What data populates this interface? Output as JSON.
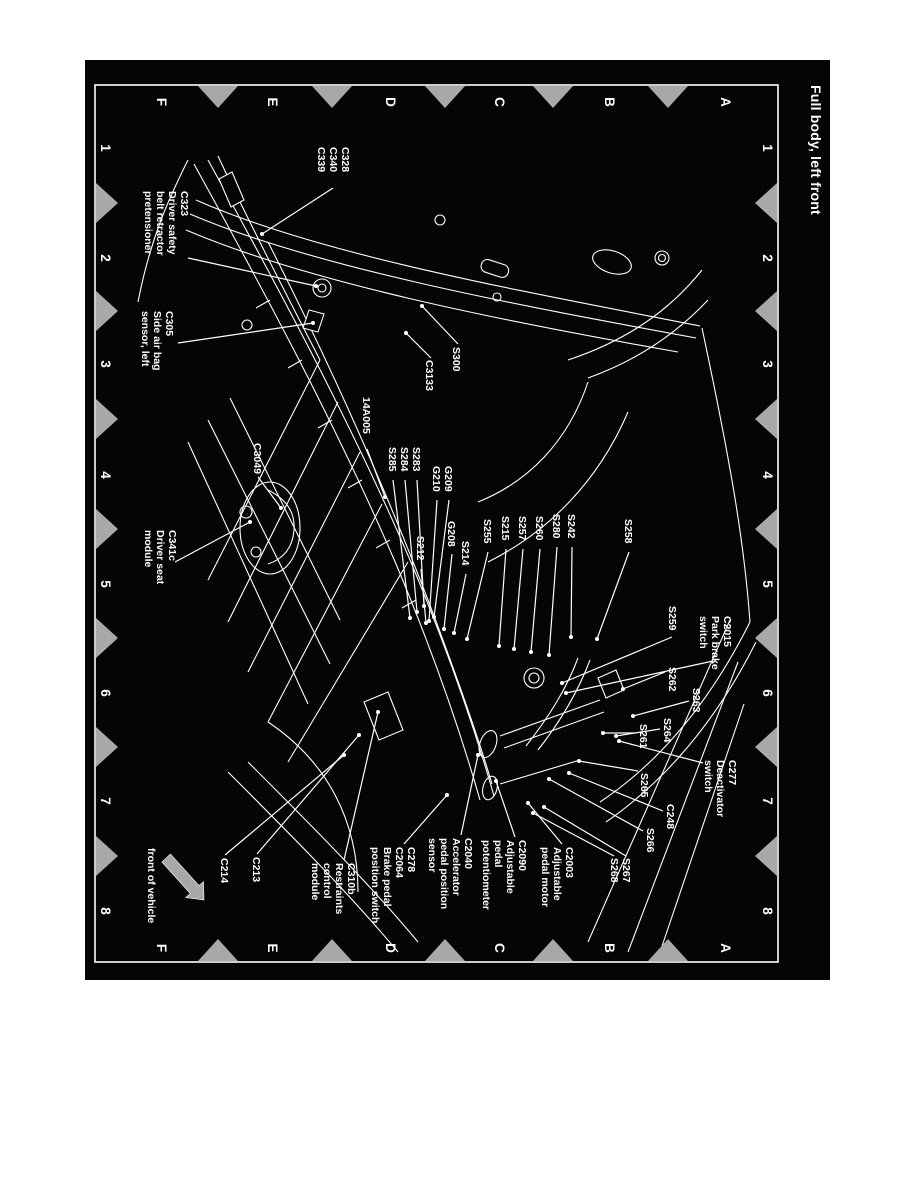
{
  "title": "Full body, left front",
  "front": {
    "label": "front of vehicle"
  },
  "grid": {
    "column_labels": [
      "1",
      "2",
      "3",
      "4",
      "5",
      "6",
      "7",
      "8"
    ],
    "row_labels": [
      "A",
      "B",
      "C",
      "D",
      "E",
      "F"
    ]
  },
  "colors": {
    "paper": "#ffffff",
    "sheet_background": "#050505",
    "ink": "#ffffff",
    "registration_mark": "#a8a8a8"
  },
  "labels": [
    {
      "id": "C328-group",
      "lines": [
        "C328",
        "C340",
        "C339"
      ],
      "x": 87,
      "y": 488,
      "leaders": [
        [
          128,
          497,
          174,
          568
        ]
      ]
    },
    {
      "id": "C323",
      "lines": [
        "C323",
        "Driver safety",
        "belt retractor",
        "pretensioner"
      ],
      "x": 131,
      "y": 649,
      "leaders": [
        [
          198,
          642,
          226,
          514
        ]
      ]
    },
    {
      "id": "C305",
      "lines": [
        "C305",
        "Side air bag",
        "sensor, left"
      ],
      "x": 251,
      "y": 664,
      "leaders": [
        [
          283,
          652,
          263,
          517
        ]
      ]
    },
    {
      "id": "S300",
      "lines": [
        "S300"
      ],
      "x": 287,
      "y": 377,
      "leaders": [
        [
          284,
          372,
          246,
          408
        ]
      ]
    },
    {
      "id": "C3133",
      "lines": [
        "C3133"
      ],
      "x": 300,
      "y": 404,
      "leaders": [
        [
          298,
          399,
          273,
          424
        ]
      ]
    },
    {
      "id": "14A005",
      "lines": [
        "14A005"
      ],
      "x": 337,
      "y": 467,
      "leaders": [
        [
          389,
          463,
          437,
          445
        ]
      ]
    },
    {
      "id": "S283-group",
      "lines": [
        "S283",
        "S284",
        "S285"
      ],
      "x": 387,
      "y": 417,
      "leaders": [
        [
          420,
          413,
          546,
          406
        ],
        [
          420,
          425,
          552,
          413
        ],
        [
          420,
          437,
          558,
          420
        ]
      ]
    },
    {
      "id": "G209-group",
      "lines": [
        "G209",
        "G210"
      ],
      "x": 406,
      "y": 385,
      "leaders": [
        [
          440,
          381,
          557,
          396
        ],
        [
          440,
          393,
          561,
          401
        ]
      ]
    },
    {
      "id": "S212",
      "lines": [
        "S212"
      ],
      "x": 476,
      "y": 413,
      "leaders": [
        [
          509,
          409,
          563,
          404
        ]
      ]
    },
    {
      "id": "G208",
      "lines": [
        "G208"
      ],
      "x": 461,
      "y": 382,
      "leaders": [
        [
          494,
          378,
          569,
          386
        ]
      ]
    },
    {
      "id": "S214",
      "lines": [
        "S214"
      ],
      "x": 481,
      "y": 368,
      "leaders": [
        [
          514,
          364,
          573,
          376
        ]
      ]
    },
    {
      "id": "S255",
      "lines": [
        "S255"
      ],
      "x": 459,
      "y": 346,
      "leaders": [
        [
          492,
          342,
          579,
          363
        ]
      ]
    },
    {
      "id": "S215",
      "lines": [
        "S215"
      ],
      "x": 456,
      "y": 328,
      "leaders": [
        [
          489,
          324,
          586,
          331
        ]
      ]
    },
    {
      "id": "S257",
      "lines": [
        "S257"
      ],
      "x": 456,
      "y": 311,
      "leaders": [
        [
          489,
          307,
          589,
          316
        ]
      ]
    },
    {
      "id": "S260",
      "lines": [
        "S260"
      ],
      "x": 456,
      "y": 294,
      "leaders": [
        [
          489,
          290,
          592,
          299
        ]
      ]
    },
    {
      "id": "S280",
      "lines": [
        "S280"
      ],
      "x": 454,
      "y": 277,
      "leaders": [
        [
          487,
          273,
          595,
          281
        ]
      ]
    },
    {
      "id": "S242",
      "lines": [
        "S242"
      ],
      "x": 454,
      "y": 262,
      "leaders": [
        [
          487,
          258,
          577,
          259
        ]
      ]
    },
    {
      "id": "S258",
      "lines": [
        "S258"
      ],
      "x": 459,
      "y": 205,
      "leaders": [
        [
          492,
          201,
          579,
          233
        ]
      ]
    },
    {
      "id": "S259",
      "lines": [
        "S259"
      ],
      "x": 546,
      "y": 161,
      "leaders": [
        [
          577,
          158,
          623,
          268
        ]
      ]
    },
    {
      "id": "C2015",
      "lines": [
        "C2015",
        "Park brake",
        "switch"
      ],
      "x": 556,
      "y": 106,
      "leaders": [
        [
          601,
          117,
          633,
          264
        ]
      ]
    },
    {
      "id": "S262",
      "lines": [
        "S262"
      ],
      "x": 607,
      "y": 161,
      "leaders": [
        [
          612,
          165,
          629,
          207
        ]
      ]
    },
    {
      "id": "S263",
      "lines": [
        "S263"
      ],
      "x": 628,
      "y": 137,
      "leaders": [
        [
          641,
          141,
          656,
          197
        ]
      ]
    },
    {
      "id": "S264",
      "lines": [
        "S264"
      ],
      "x": 658,
      "y": 166,
      "leaders": [
        [
          669,
          170,
          676,
          214
        ]
      ]
    },
    {
      "id": "S261",
      "lines": [
        "S261"
      ],
      "x": 664,
      "y": 190,
      "leaders": [
        [
          673,
          194,
          673,
          227
        ]
      ]
    },
    {
      "id": "C277",
      "lines": [
        "C277",
        "Deactivator",
        "switch"
      ],
      "x": 700,
      "y": 101,
      "leaders": [
        [
          703,
          127,
          681,
          211
        ]
      ]
    },
    {
      "id": "S265",
      "lines": [
        "S265"
      ],
      "x": 713,
      "y": 189,
      "leaders": [
        [
          711,
          192,
          701,
          251
        ]
      ]
    },
    {
      "id": "C248",
      "lines": [
        "C248"
      ],
      "x": 744,
      "y": 163,
      "leaders": [
        [
          751,
          167,
          713,
          261
        ]
      ]
    },
    {
      "id": "S266",
      "lines": [
        "S266"
      ],
      "x": 768,
      "y": 183,
      "leaders": [
        [
          771,
          187,
          719,
          281
        ]
      ]
    },
    {
      "id": "S267-group",
      "lines": [
        "S267",
        "S268"
      ],
      "x": 798,
      "y": 207,
      "leaders": [
        [
          796,
          204,
          747,
          286
        ],
        [
          796,
          216,
          753,
          297
        ]
      ]
    },
    {
      "id": "C2003",
      "lines": [
        "C2003",
        "Adjustable",
        "pedal motor"
      ],
      "x": 787,
      "y": 264,
      "leaders": [
        [
          784,
          268,
          743,
          302
        ]
      ]
    },
    {
      "id": "C2090",
      "lines": [
        "C2090",
        "Adjustable",
        "pedal",
        "potentiometer"
      ],
      "x": 780,
      "y": 311,
      "leaders": [
        [
          777,
          315,
          721,
          334
        ]
      ]
    },
    {
      "id": "C2040",
      "lines": [
        "C2040",
        "Accelerator",
        "pedal position",
        "sensor"
      ],
      "x": 778,
      "y": 365,
      "leaders": [
        [
          775,
          369,
          695,
          352
        ]
      ]
    },
    {
      "id": "C278",
      "lines": [
        "C278",
        "C2064",
        "Brake pedal",
        "position switch"
      ],
      "x": 787,
      "y": 422,
      "leaders": [
        [
          784,
          426,
          735,
          383
        ]
      ]
    },
    {
      "id": "C310b",
      "lines": [
        "C310b",
        "Restraints",
        "control",
        "module"
      ],
      "x": 803,
      "y": 482,
      "leaders": [
        [
          800,
          486,
          652,
          452
        ]
      ]
    },
    {
      "id": "C213",
      "lines": [
        "C213"
      ],
      "x": 797,
      "y": 577,
      "leaders": [
        [
          794,
          573,
          675,
          471
        ]
      ]
    },
    {
      "id": "C214",
      "lines": [
        "C214"
      ],
      "x": 798,
      "y": 609,
      "leaders": [
        [
          795,
          605,
          695,
          486
        ]
      ]
    },
    {
      "id": "C3049",
      "lines": [
        "C3049"
      ],
      "x": 383,
      "y": 576,
      "leaders": [
        [
          417,
          572,
          448,
          549
        ]
      ]
    },
    {
      "id": "C341c",
      "lines": [
        "C341c",
        "Driver seat",
        "module"
      ],
      "x": 470,
      "y": 661,
      "leaders": [
        [
          502,
          655,
          462,
          580
        ]
      ]
    }
  ]
}
